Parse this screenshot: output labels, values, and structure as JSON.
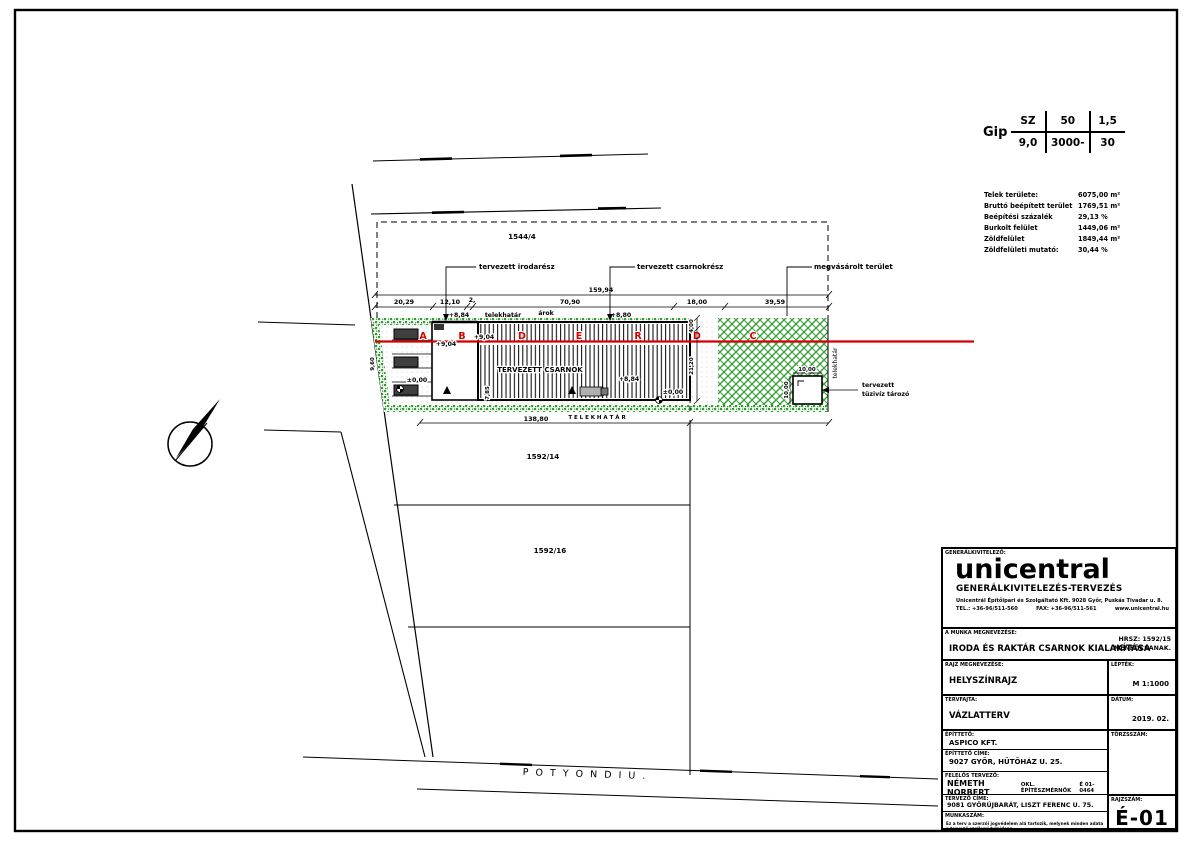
{
  "zoning": {
    "code": "Gip",
    "row1": [
      "SZ",
      "50",
      "1,5"
    ],
    "row2": [
      "9,0",
      "3000-",
      "30"
    ]
  },
  "stats": {
    "rows": [
      {
        "label": "Telek területe:",
        "value": "6075,00 m²"
      },
      {
        "label": "Bruttó beépített terület",
        "value": "1769,51 m²"
      },
      {
        "label": "Beépítési százalék",
        "value": "29,13 %"
      },
      {
        "label": "Burkolt felület",
        "value": "1449,06 m²"
      },
      {
        "label": "Zöldfelület",
        "value": "1849,44 m²"
      },
      {
        "label": "Zöldfelületi mutató:",
        "value": "30,44 %"
      }
    ]
  },
  "plan": {
    "parcels": {
      "north": "1544/4",
      "mid": "1592/14",
      "south": "1592/16"
    },
    "street": "P O T Y O N D I   U .",
    "callouts": {
      "office": "tervezett irodarész",
      "hall": "tervezett csarnokrész",
      "purchased": "megvásárolt terület",
      "reservoir_1": "tervezett",
      "reservoir_2": "tüzivíz tározó"
    },
    "labels": {
      "plot_boundary": "telekhatár",
      "plot_boundary_right": "telekhatár",
      "plot_boundary_caps": "T E L E K H A T Á R",
      "ditch": "árok",
      "hall_name": "TERVEZETT CSARNOK"
    },
    "zone_letters": [
      "A",
      "B",
      "D",
      "E",
      "R",
      "D",
      "C"
    ],
    "levels": [
      "+8,84",
      "+8,80",
      "+9,04",
      "+9,04",
      "+8,84",
      "±0,00",
      "±0,00"
    ],
    "dims": {
      "overall": "159,94",
      "chain": [
        "20,29",
        "12,10",
        "2,",
        "70,90",
        "18,00",
        "39,59"
      ],
      "south": "138,80",
      "right_top": "4,00",
      "right_mid": "21,20",
      "west": "9,60",
      "office_depth": "7,85",
      "res_w": "10,00",
      "res_h": "10,00"
    }
  },
  "titleblock": {
    "role_label": "GENERÁLKIVITELEZŐ:",
    "logo": "unicentral",
    "logo_sub": "GENERÁLKIVITELEZÉS-TERVEZÉS",
    "address": "Unicentrál Építőipari és Szolgáltató Kft. 9028 Győr, Puskás Tivadar u. 8.",
    "tel": "TEL.: +36-96/511-560",
    "fax": "FAX: +36-96/511-561",
    "web": "www.unicentral.hu",
    "project_label": "A MUNKA MEGNEVEZÉSE:",
    "project_title": "IRODA ÉS RAKTÁR CSARNOK KIALAKÍTÁSA",
    "hrsz": "HRSZ: 1592/15",
    "city": "MÉNFŐCSANAK.",
    "drawing_label": "RAJZ MEGNEVEZÉSE:",
    "drawing_title": "HELYSZÍNRAJZ",
    "scale_label": "LÉPTÉK:",
    "scale": "M 1:1000",
    "phase_label": "TERVFAJTA:",
    "phase": "VÁZLATTERV",
    "date_label": "DÁTUM:",
    "date": "2019. 02.",
    "client_label": "ÉPÍTTETŐ:",
    "client": "ASPICO KFT.",
    "client_addr_label": "ÉPÍTTETŐ CÍME:",
    "client_addr": "9027 GYŐR, HŰTŐHÁZ U. 25.",
    "designer_label": "FELELŐS TERVEZŐ:",
    "designer": "NÉMETH NORBERT",
    "designer_title": "OKL. ÉPÍTÉSZMÉRNÖK",
    "designer_reg": "É 01-0464",
    "designer_addr_label": "TERVEZŐ CÍME:",
    "designer_addr": "9081 GYŐRÚJBARÁT, LISZT FERENC U. 75.",
    "worknum_label": "MUNKASZÁM:",
    "regnum_label": "TÖRZSSZÁM:",
    "dwgnum_label": "RAJZSZÁM:",
    "dwgnum": "É-01",
    "fineprint_1": "Ez a terv a szerzői jogvédelem alá tartozik, melynek minden adata a tervező szellemi tulajdona.",
    "fineprint_2": "Külön engedély nélkül a terv sem egészében, sem részleteiben fel nem használható!"
  }
}
